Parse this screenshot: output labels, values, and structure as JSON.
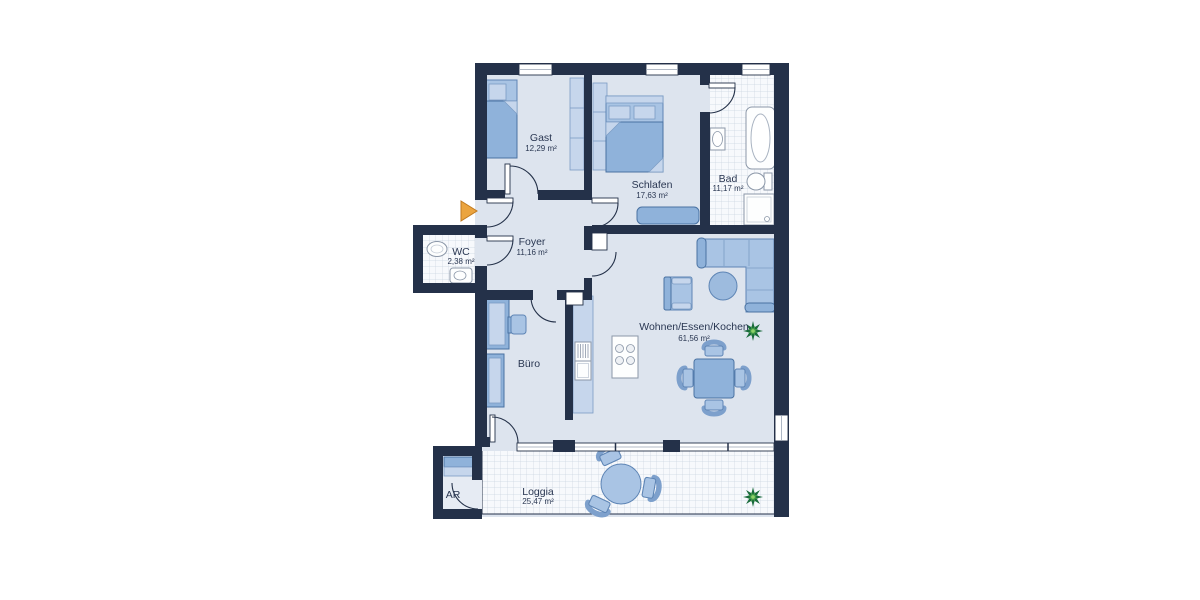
{
  "plan": {
    "type": "apartment-floorplan",
    "rooms": {
      "gast": {
        "name": "Gast",
        "area": "12,29 m²"
      },
      "schlafen": {
        "name": "Schlafen",
        "area": "17,63 m²"
      },
      "bad": {
        "name": "Bad",
        "area": "11,17 m²"
      },
      "wc": {
        "name": "WC",
        "area": "2,38 m²"
      },
      "foyer": {
        "name": "Foyer",
        "area": "11,16 m²"
      },
      "buero": {
        "name": "Büro"
      },
      "wohnen": {
        "name": "Wohnen/Essen/Kochen",
        "area": "61,56 m²"
      },
      "ar": {
        "name": "AR"
      },
      "loggia": {
        "name": "Loggia",
        "area": "25,47 m²"
      }
    },
    "colors": {
      "wall": "#243149",
      "floor": "#dde4ee",
      "tile": "#f7f9fc",
      "tile_grid": "#ccd5e0",
      "furniture": "#8fb2da",
      "furniture_light": "#a9c4e4",
      "furniture_pale": "#c6d6ec",
      "fixture_white": "#fdfefe",
      "entry_arrow": "#eba43f",
      "plant_dark": "#1a6b3c",
      "plant_light": "#4aa54a",
      "label_text": "#2a3752"
    }
  }
}
